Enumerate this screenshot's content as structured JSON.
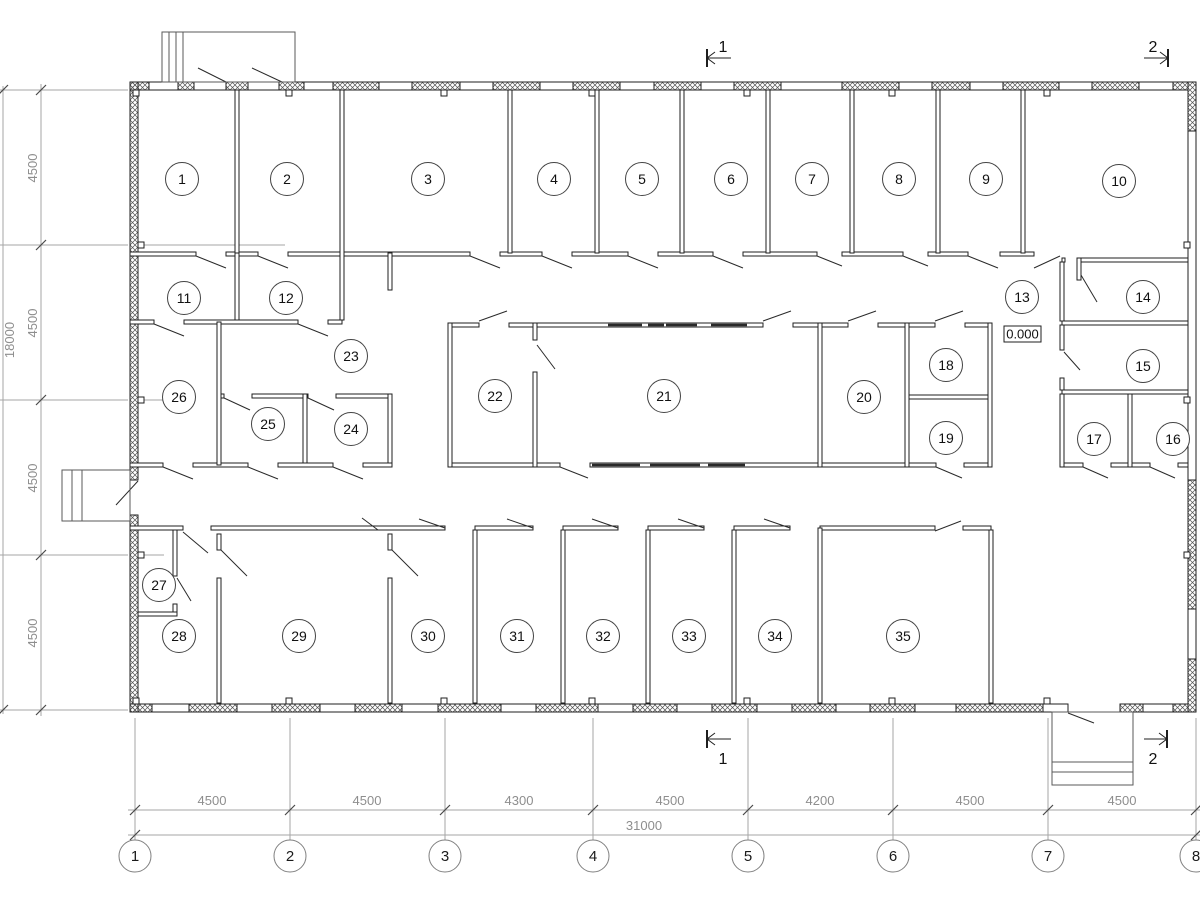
{
  "plan": {
    "rooms": [
      "1",
      "2",
      "3",
      "4",
      "5",
      "6",
      "7",
      "8",
      "9",
      "10",
      "11",
      "12",
      "13",
      "14",
      "15",
      "16",
      "17",
      "18",
      "19",
      "20",
      "21",
      "22",
      "23",
      "24",
      "25",
      "26",
      "27",
      "28",
      "29",
      "30",
      "31",
      "32",
      "33",
      "34",
      "35"
    ],
    "elevation_mark": "0.000"
  },
  "dimensions": {
    "bottom_spans": [
      "4500",
      "4500",
      "4300",
      "4500",
      "4200",
      "4500",
      "4500"
    ],
    "bottom_total": "31000",
    "left_spans": [
      "4500",
      "4500",
      "4500",
      "4500"
    ],
    "left_total": "18000"
  },
  "grid": {
    "columns": [
      "1",
      "2",
      "3",
      "4",
      "5",
      "6",
      "7",
      "8"
    ]
  },
  "sections": {
    "cut_1_top": "1",
    "cut_2_top": "2",
    "cut_1_bottom": "1",
    "cut_2_bottom": "2"
  },
  "colors": {
    "wall_line": "#1f1f1f",
    "construction_line": "#a6a6a6",
    "dimension_text": "#8e8e8e"
  }
}
